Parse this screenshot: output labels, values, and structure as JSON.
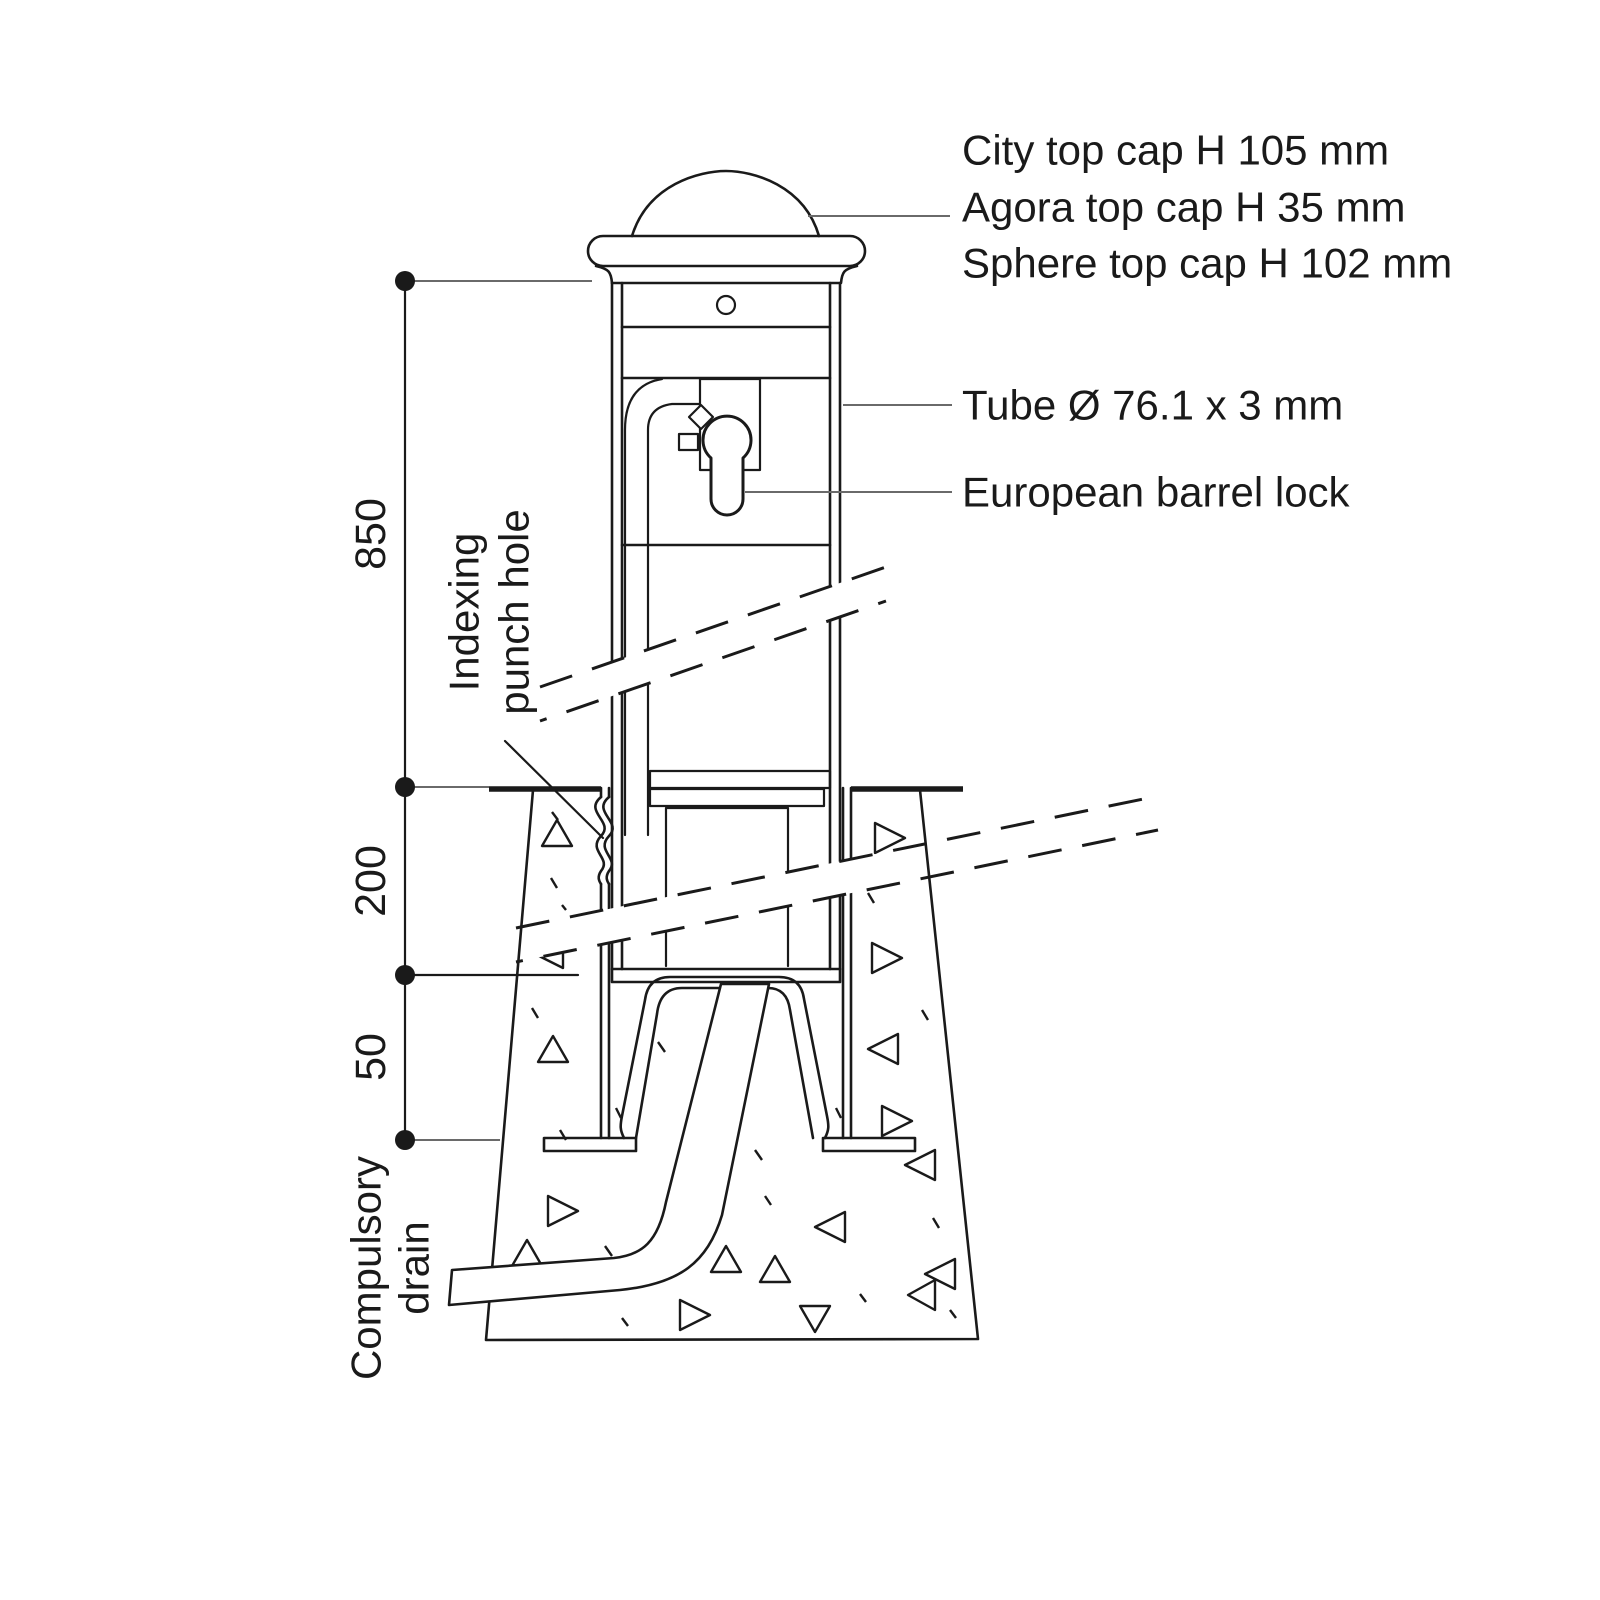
{
  "diagram": {
    "cap_labels": [
      "City top cap H 105 mm",
      "Agora top cap H 35 mm",
      "Sphere top cap H 102 mm"
    ],
    "tube_label": "Tube Ø 76.1 x 3 mm",
    "lock_label": "European barrel lock",
    "indexing_label": [
      "Indexing",
      "punch hole"
    ],
    "drain_label": [
      "Compulsory",
      "drain"
    ],
    "dimensions": {
      "above_ground": "850",
      "embed_depth": "200",
      "base_gap": "50"
    },
    "colors": {
      "line": "#1a1a1a",
      "leader": "#6a6a6a",
      "background": "#ffffff"
    }
  }
}
